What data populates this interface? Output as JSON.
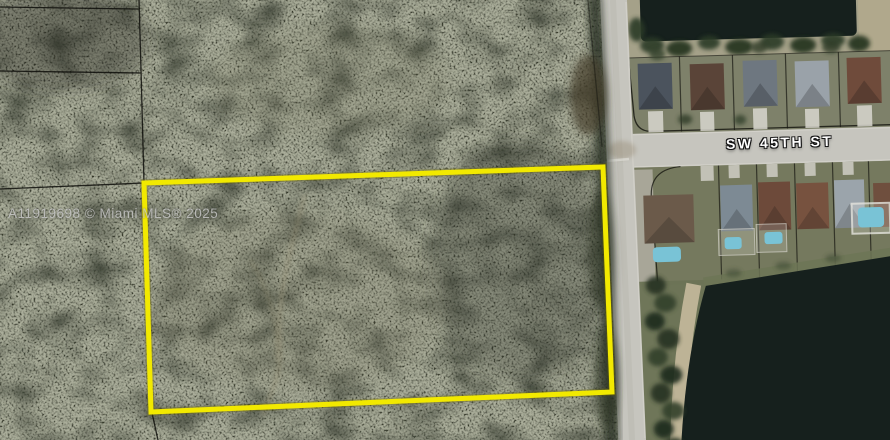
{
  "listing_map": {
    "watermark_text": "A11919698 © Miami MLS® 2025",
    "street_label": "SW 45TH ST",
    "boundary_color": "#f2e900",
    "colors": {
      "woods": "#343729",
      "road_pavement": "#c6c5be",
      "pond_water": "#16201d",
      "residential_ground": "#7e816a",
      "shore_sand": "#c2b69a",
      "pool_water": "#79c3d6",
      "watermark_text_color": "#c6c6c6",
      "street_label_color": "#ffffff",
      "parcel_line": "#121209"
    }
  }
}
